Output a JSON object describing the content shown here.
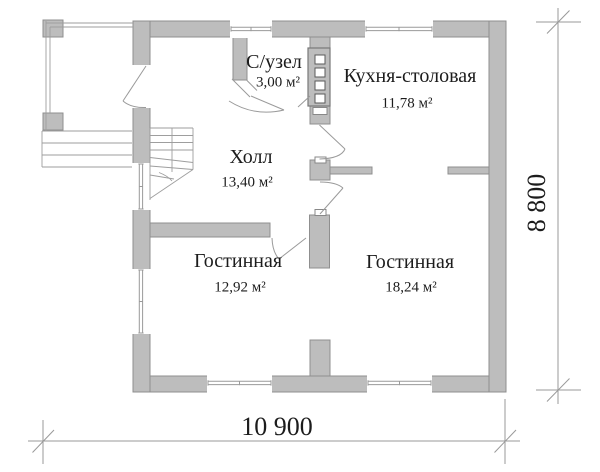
{
  "plan": {
    "rooms": [
      {
        "id": "bathroom",
        "label": "С/узел",
        "area": "3,00 м²"
      },
      {
        "id": "kitchen-dining",
        "label": "Кухня-столовая",
        "area": "11,78 м²"
      },
      {
        "id": "hall",
        "label": "Холл",
        "area": "13,40 м²"
      },
      {
        "id": "living-room-left",
        "label": "Гостинная",
        "area": "12,92 м²"
      },
      {
        "id": "living-room-right",
        "label": "Гостинная",
        "area": "18,24 м²"
      }
    ],
    "dimensions": {
      "overall_width": "10 900",
      "overall_height": "8 800"
    },
    "colors": {
      "wall_fill": "#bdbdbd",
      "wall_edge": "#8f8f8f",
      "thin_line": "#9a9a9a",
      "text": "#1c1c1c",
      "background": "#ffffff"
    }
  }
}
